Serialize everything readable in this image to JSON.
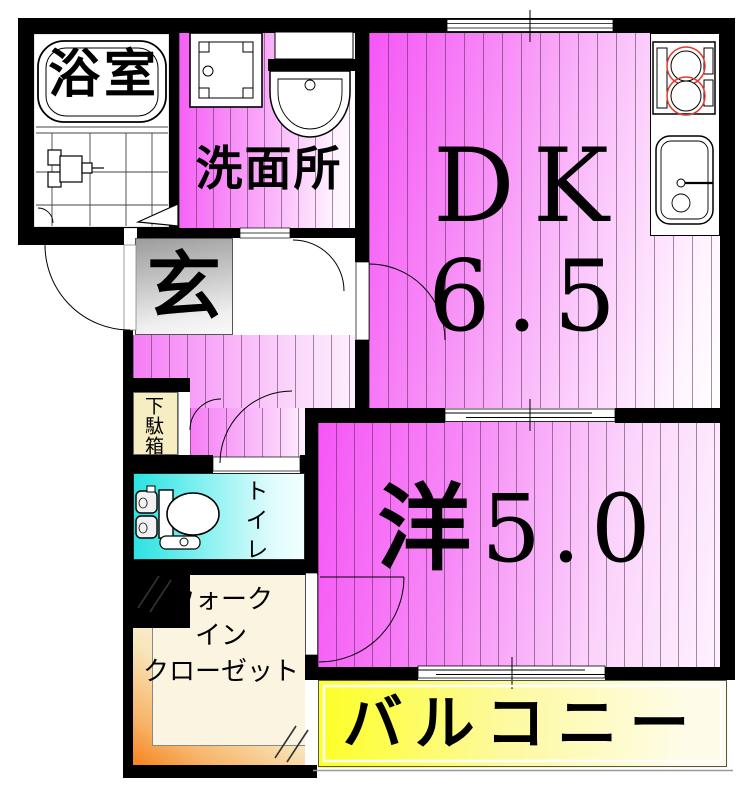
{
  "plan": {
    "type": "apartment-floor-plan",
    "rooms": {
      "bathroom": {
        "label": "浴室"
      },
      "washroom": {
        "label": "洗面所"
      },
      "entrance": {
        "label": "玄"
      },
      "shoe_cabinet": {
        "label": "下駄箱"
      },
      "toilet": {
        "label": "トイレ"
      },
      "dining_kitchen": {
        "label": "DK",
        "size": "6.5"
      },
      "western_room": {
        "label": "洋",
        "size": "5.0"
      },
      "walk_in_closet": {
        "line1": "ウォーク",
        "line2": "イン",
        "line3": "クローゼット"
      },
      "balcony": {
        "label": "バルコニー"
      }
    },
    "fixtures": [
      "bathtub",
      "bath-folding-door",
      "washing-machine-pan",
      "vanity-sink",
      "kitchen-stove",
      "kitchen-sink",
      "toilet-bowl",
      "entrance-door-swing",
      "dk-door-swing",
      "toilet-door-swing",
      "closet-door-swing",
      "sliding-window"
    ],
    "colors": {
      "wall": "#000000",
      "floor_pink": "#f656f6",
      "toilet_cyan": "#2be2e2",
      "balcony_yellow": "#fdff24",
      "closet_orange": "#f5831c",
      "closet_cream": "#faf3dc",
      "entrance_gray": "#a2a2a2",
      "shoe_cabinet_cream": "#f6eec2",
      "burner_red": "#e23b2e"
    }
  }
}
